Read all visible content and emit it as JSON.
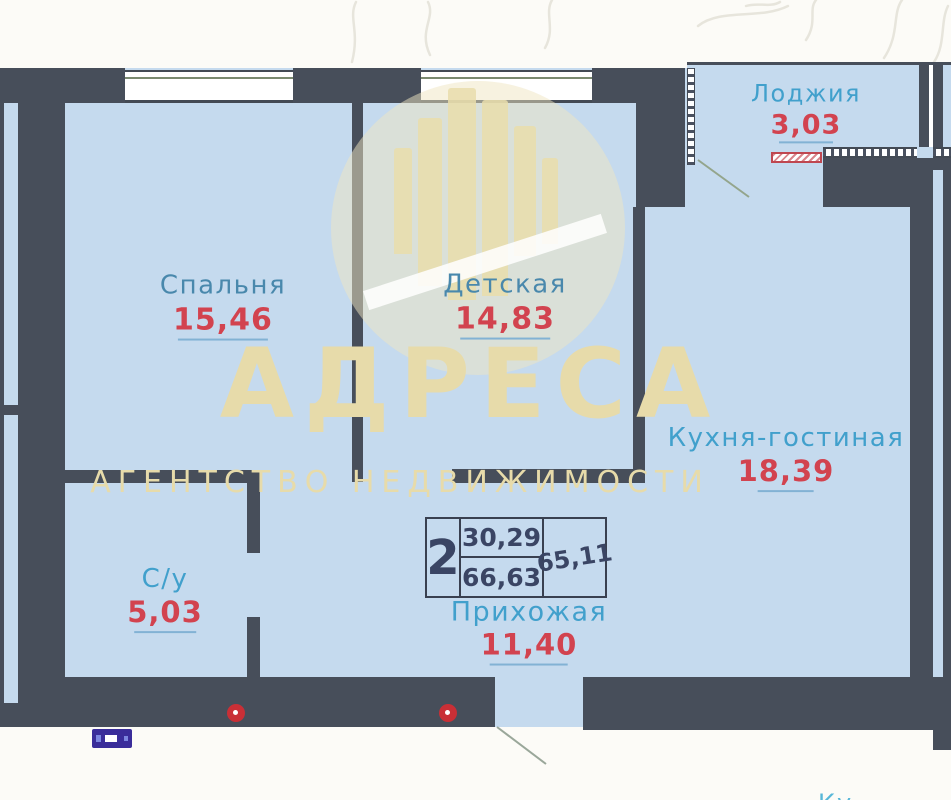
{
  "plan": {
    "rooms": [
      {
        "name": "Спальня",
        "area": "15,46"
      },
      {
        "name": "Детская",
        "area": "14,83"
      },
      {
        "name": "Лоджия",
        "area": "3,03"
      },
      {
        "name": "Кухня-гостиная",
        "area": "18,39"
      },
      {
        "name": "С/у",
        "area": "5,03"
      },
      {
        "name": "Прихожая",
        "area": "11,40"
      }
    ],
    "stamp": {
      "rooms_count": "2",
      "living_area": "30,29",
      "total_area": "66,63",
      "alt_total_area": "65,11"
    },
    "bottom_partial_label": "Ку"
  },
  "watermark": {
    "title": "АДРЕСА",
    "subtitle": "АГЕНТСТВО НЕДВИЖИМОСТИ"
  },
  "colors": {
    "wall": "#474e5a",
    "room_fill": "#c5daee",
    "label_steel_blue": "#4988ac",
    "label_cyan": "#41a0cc",
    "area_red": "#d2434f",
    "underline_blue": "#82b2d4",
    "stamp_navy": "#3a4564",
    "watermark_beige": "#e7dbaa",
    "riser_red": "#c92f36",
    "entry_marker_indigo": "#3a2d9a"
  }
}
